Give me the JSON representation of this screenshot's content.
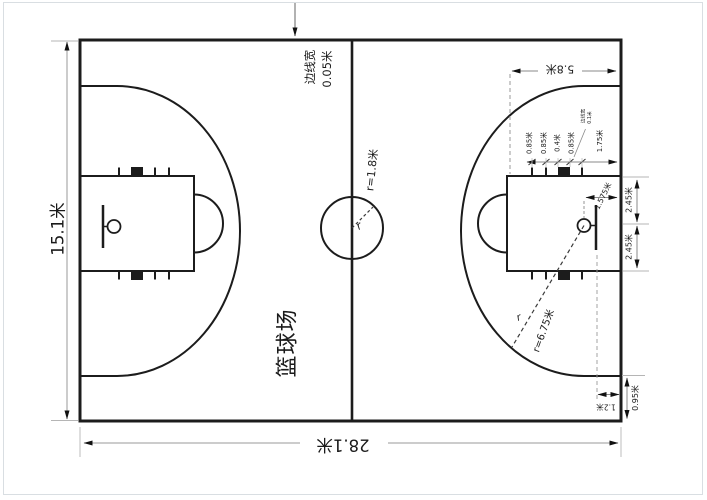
{
  "diagram": {
    "title": "篮球场",
    "dimensions": {
      "court_width": "15.1米",
      "court_length": "28.1米",
      "sideline_width": [
        "边线宽",
        "0.05米"
      ],
      "center_circle_radius": "r=1.8米",
      "radius_symbol_center": "r",
      "free_throw_line_distance": "5.8米",
      "lane_hash_segments": [
        "0.85米",
        "0.85米",
        "0.4米",
        "0.85米"
      ],
      "first_hash_from_baseline": "1.75米",
      "lane_line_width": [
        "边线宽",
        "0.1米"
      ],
      "basket_center_to_baseline": "1.575米",
      "basket_to_lane_edge_upper": "2.45米",
      "basket_to_lane_edge_lower": "2.45米",
      "three_point_radius": "r=6.75米",
      "radius_symbol_three_point": "r",
      "backboard_to_baseline": "1.2米",
      "three_point_line_to_sideline": "0.95米"
    }
  }
}
